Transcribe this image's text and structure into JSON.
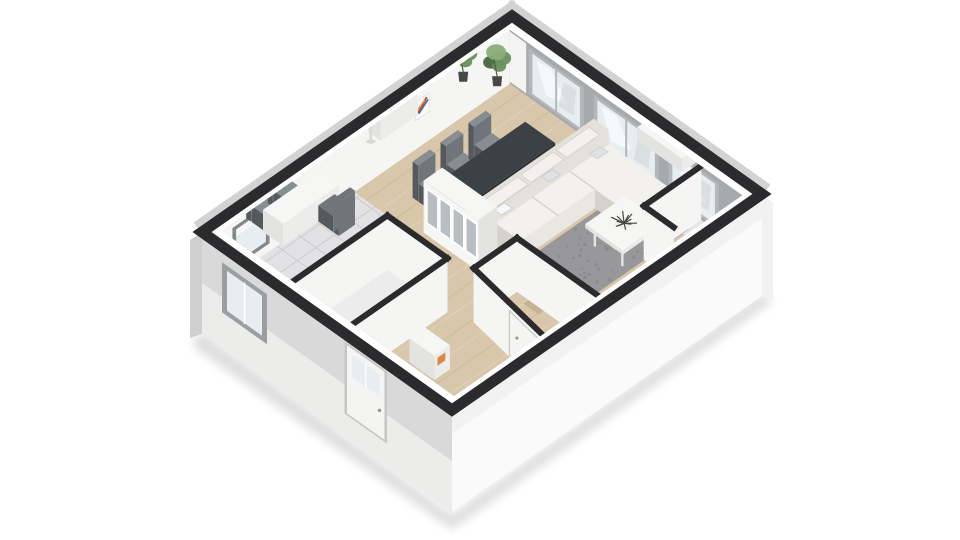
{
  "scene": {
    "type": "3d-floorplan-isometric-render",
    "floor_label": "ground-floor-apartment",
    "background": "#ffffff"
  },
  "colors": {
    "background": "#ffffff",
    "wall_top": "#2b2b2d",
    "wall_face": "#f5f5f4",
    "wall_face_shade": "#ebebea",
    "exterior_face_left": "#d9d9d9",
    "exterior_face_left_light": "#f0f0ef",
    "exterior_face_right": "#fafafa",
    "exterior_face_right_shade": "#ededec",
    "exterior_sliver": "#d3d3d3",
    "window_wall": "#a7aaac",
    "window_frame": "#b4b8ba",
    "window_pane": "#e8edef",
    "window_streak": "#ffffff",
    "window_shadow": "#c7d0cd",
    "wood_floor": "#d8c7aa",
    "wood_streak_dark": "#c6b392",
    "wood_streak_light": "#e5d8bd",
    "tile_floor": "#e2e2e4",
    "tile_line": "#cccccf",
    "light_floor": "#ececed",
    "closet_floor": "#e6e6e7",
    "rug": "#98989b",
    "rug_dark": "#7e7e81",
    "sofa_base": "#e9e7e2",
    "sofa_cushion": "#f3f1ed",
    "sofa_back": "#e4e1da",
    "sofa_shadow": "#d5d2cb",
    "pillow": "#dfe2e4",
    "pillow_white": "#f7f7f7",
    "dining_table": "#3c4146",
    "dining_table_side": "#2e3237",
    "chair": "#878d91",
    "chair_dark": "#6f757a",
    "chair_leg": "#55595d",
    "white_furniture": "#f6f6f5",
    "furniture_side": "#e3e3e1",
    "furniture_front": "#ececea",
    "glass_door": "#b9bec2",
    "plant_green": "#6a8f5f",
    "plant_green_dark": "#46663f",
    "plant_green_light": "#8aac76",
    "plant_pot": "#47474a",
    "lamp_shade_top": "#d2aa78",
    "lamp_shade": "#efe8d8",
    "lamp_pole": "#d9d9d7",
    "coral_decor": "#4a4642",
    "accent_orange": "#d9884a",
    "art_red": "#d0493c",
    "art_blue": "#3f6fb5",
    "art_yellow": "#e0a33c",
    "door_white": "#f4f4f3",
    "door_frame": "#c9c9c7",
    "handle": "#9a9a9a",
    "shadow": "#000000"
  },
  "rooms": [
    {
      "id": "living-dining-room",
      "floor": "wood"
    },
    {
      "id": "kitchen-nook",
      "floor": "tile"
    },
    {
      "id": "wc",
      "floor": "light"
    },
    {
      "id": "entry-hall",
      "floor": "wood"
    },
    {
      "id": "staircase",
      "floor": "wood-steps"
    },
    {
      "id": "storage-closet",
      "floor": "light"
    }
  ],
  "furniture": [
    {
      "id": "dining-table",
      "color_key": "dining_table"
    },
    {
      "id": "dining-chair",
      "count": 6
    },
    {
      "id": "sectional-sofa",
      "pillow_count": 3
    },
    {
      "id": "chaise-lounge"
    },
    {
      "id": "coffee-table"
    },
    {
      "id": "decorative-coral-bowl"
    },
    {
      "id": "area-rug"
    },
    {
      "id": "display-cabinet",
      "glass_door_count": 4
    },
    {
      "id": "kitchen-table"
    },
    {
      "id": "kitchen-chair",
      "count": 3
    },
    {
      "id": "floor-lamp"
    },
    {
      "id": "sideboard-radiator"
    },
    {
      "id": "potted-plant",
      "count": 2
    },
    {
      "id": "wall-art-relief"
    },
    {
      "id": "wall-art-colorful"
    },
    {
      "id": "window-bench"
    },
    {
      "id": "entry-console",
      "accent": "orange-books"
    }
  ],
  "openings": {
    "back_wall_windows": [
      [
        11,
        33
      ],
      [
        37,
        63
      ],
      [
        67,
        87
      ]
    ],
    "roller_blind_box": [
      3.5,
      10
    ],
    "left_wall_window": [
      8,
      26
    ],
    "kitchen_wall_window": [
      7,
      19
    ],
    "front_door": [
      58,
      73
    ],
    "under_stair_door": 1
  },
  "stairs": {
    "visible_steps": 5
  }
}
